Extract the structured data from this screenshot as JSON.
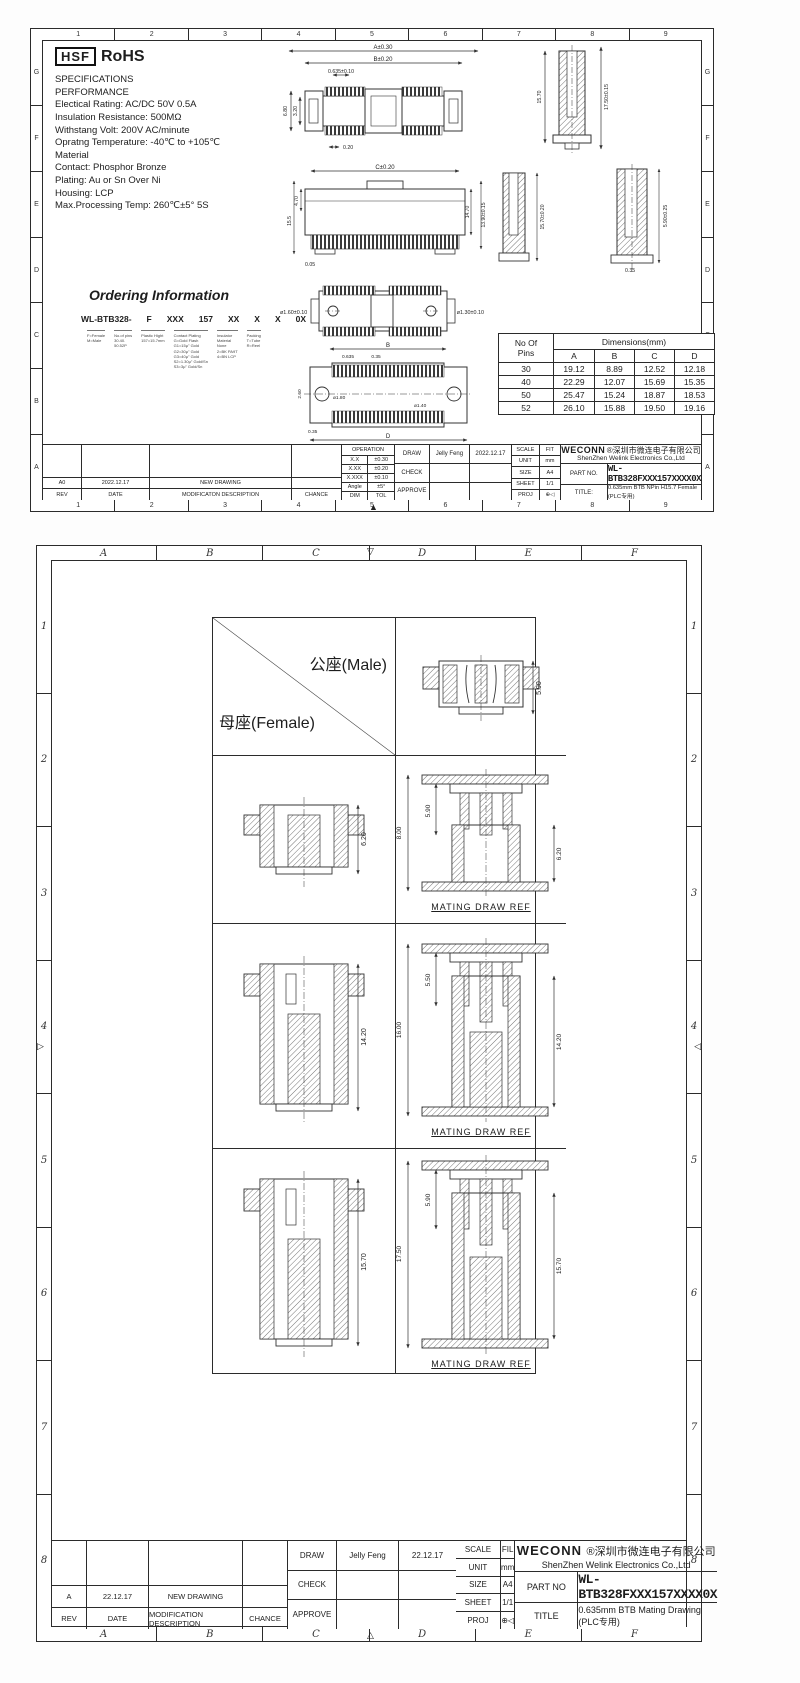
{
  "page1": {
    "zone_cols": [
      "1",
      "2",
      "3",
      "4",
      "5",
      "6",
      "7",
      "8",
      "9"
    ],
    "zone_rows": [
      "G",
      "F",
      "E",
      "D",
      "C",
      "B",
      "A"
    ],
    "logo": {
      "hsf": "HSF",
      "rohs": "RoHS"
    },
    "specs": {
      "lines": [
        "SPECIFICATIONS",
        "PERFORMANCE",
        "Electical Rating: AC/DC 50V 0.5A",
        "Insulation Resistance:   500MΩ",
        "Withstang Volt: 200V AC/minute",
        "Opratng Temperature: -40℃ to +105℃",
        "Material",
        "Contact: Phosphor Bronze",
        "Plating: Au or Sn Over Ni",
        "Housing: LCP",
        "Max.Processing Temp: 260℃±5°  5S"
      ]
    },
    "ordering": {
      "heading": "Ordering Information",
      "code": [
        "WL-BTB328-",
        "F",
        "XXX",
        "157",
        "XX",
        "X",
        "X",
        "0X"
      ],
      "legend": [
        "F=Female\nM=Male",
        "No.of pins\n30.40.\n50.52P",
        "Plastic Hight\n157=15.7mm",
        "Contact Plating\nG=Gold Flash\nG1=15μ\" Gold\nG2=30μ\" Gold\nG3=40μ\" Gold\nS2=1.30μ\" Gold/Sn\nS3=3μ\" Gold/Sn",
        "Insulator\nMaterial\nNone\n2=BK PA9T\n4=BN LCP",
        "Packing\nT=Tube\nR=Reel"
      ]
    },
    "dim_table": {
      "header_pins": "No Of\nPins",
      "header_dims": "Dimensions(mm)",
      "cols": [
        "A",
        "B",
        "C",
        "D"
      ],
      "rows": [
        [
          "30",
          "19.12",
          "8.89",
          "12.52",
          "12.18"
        ],
        [
          "40",
          "22.29",
          "12.07",
          "15.69",
          "15.35"
        ],
        [
          "50",
          "25.47",
          "15.24",
          "18.87",
          "18.53"
        ],
        [
          "52",
          "26.10",
          "15.88",
          "19.50",
          "19.16"
        ]
      ]
    },
    "drawings": {
      "top_view": {
        "A": "A±0.30",
        "B": "B±0.20",
        "pitch": "0.635±0.10",
        "h_total": "6.80",
        "h_inner": "3.20",
        "tooth": "0.20"
      },
      "side_right_top": {
        "h_body": "15.70",
        "h_total": "17.50±0.15"
      },
      "front_view": {
        "C": "C±0.20",
        "d_left_top": "4.70",
        "d_left": "15.5",
        "d_right_in": "14.70",
        "d_right": "13.90±0.15",
        "d_bottom": "0.05"
      },
      "side_left_mid": {
        "h": "15.70±0.20"
      },
      "side_right_mid": {
        "h": "5.90±0.25",
        "w": "0.35"
      },
      "pin_view": {
        "left": "ø1.60±0.10",
        "right": "ø1.30±0.10"
      },
      "pcb": {
        "B": "B",
        "pitch": "0.635",
        "pad_w": "0.35",
        "hole_l": "ø1.80",
        "hole_r": "ø1.40",
        "h": "2.60",
        "pad_h": "0.35",
        "D": "D",
        "label": "P.C.B Layout"
      }
    },
    "title_block": {
      "tol": {
        "header": "OPERATION",
        "rows": [
          [
            "X.X",
            "±0.30"
          ],
          [
            "X.XX",
            "±0.20"
          ],
          [
            "X.XXX",
            "±0.10"
          ],
          [
            "Angle",
            "±5°"
          ],
          [
            "DIM",
            "TOL"
          ]
        ]
      },
      "sign": {
        "rows": [
          [
            "DRAW",
            "Jelly Feng",
            "2022.12.17"
          ],
          [
            "CHECK",
            "",
            ""
          ],
          [
            "APPROVE",
            "",
            ""
          ]
        ]
      },
      "meta": {
        "rows": [
          [
            "SCALE",
            "FIT"
          ],
          [
            "UNIT",
            "mm"
          ],
          [
            "SIZE",
            "A4"
          ],
          [
            "SHEET",
            "1/1"
          ],
          [
            "PROJ",
            "⊕◁"
          ]
        ]
      },
      "company": {
        "name": "WECONN",
        "cn": "®深圳市微连电子有限公司",
        "en": "ShenZhen Welink Electronics Co.,Ltd"
      },
      "part_label": "PART NO.",
      "part_no": "WL-BTB328FXXX157XXXX0X",
      "title_label": "TITLE:",
      "title": "0.635mm BTB NPin H15.7 Female (PLC专用)",
      "rev_row": [
        "A0",
        "2022.12.17",
        "NEW DRAWING",
        ""
      ],
      "rev_header": [
        "REV",
        "DATE",
        "MODIFICATON DESCRIPTION",
        "CHANCE"
      ]
    }
  },
  "page2": {
    "zone_cols": [
      "A",
      "B",
      "C",
      "D",
      "E",
      "F"
    ],
    "zone_rows": [
      "1",
      "2",
      "3",
      "4",
      "5",
      "6",
      "7",
      "8"
    ],
    "matrix": {
      "male_label": "公座(Male)",
      "female_label": "母座(Female)",
      "header_dim": "5.90",
      "rows": [
        {
          "female_dim": "6.20",
          "mate_left": "8.00",
          "mate_inner": "5.90",
          "mate_right": "6.20",
          "caption": "MATING DRAW REF"
        },
        {
          "female_dim": "14.20",
          "mate_left": "16.00",
          "mate_inner": "5.50",
          "mate_right": "14.20",
          "caption": "MATING DRAW REF"
        },
        {
          "female_dim": "15.70",
          "mate_left": "17.50",
          "mate_inner": "5.90",
          "mate_right": "15.70",
          "caption": "MATING DRAW REF"
        }
      ]
    },
    "title_block": {
      "sign": {
        "rows": [
          [
            "DRAW",
            "Jelly Feng",
            "22.12.17"
          ],
          [
            "CHECK",
            "",
            ""
          ],
          [
            "APPROVE",
            "",
            ""
          ]
        ]
      },
      "meta": {
        "rows": [
          [
            "SCALE",
            "FIL"
          ],
          [
            "UNIT",
            "mm"
          ],
          [
            "SIZE",
            "A4"
          ],
          [
            "SHEET",
            "1/1"
          ],
          [
            "PROJ",
            "⊕◁"
          ]
        ]
      },
      "company": {
        "name": "WECONN",
        "cn": "®深圳市微连电子有限公司",
        "en": "ShenZhen Welink Electronics Co.,Ltd"
      },
      "part_label": "PART NO",
      "part_no": "WL-BTB328FXXX157XXXX0X",
      "title_label": "TITLE",
      "title": "0.635mm BTB Mating Drawing (PLC专用)",
      "rev_row": [
        "A",
        "22.12.17",
        "NEW DRAWING",
        ""
      ],
      "rev_header": [
        "REV",
        "DATE",
        "MODIFICATION DESCRIPTION",
        "CHANCE"
      ]
    }
  }
}
